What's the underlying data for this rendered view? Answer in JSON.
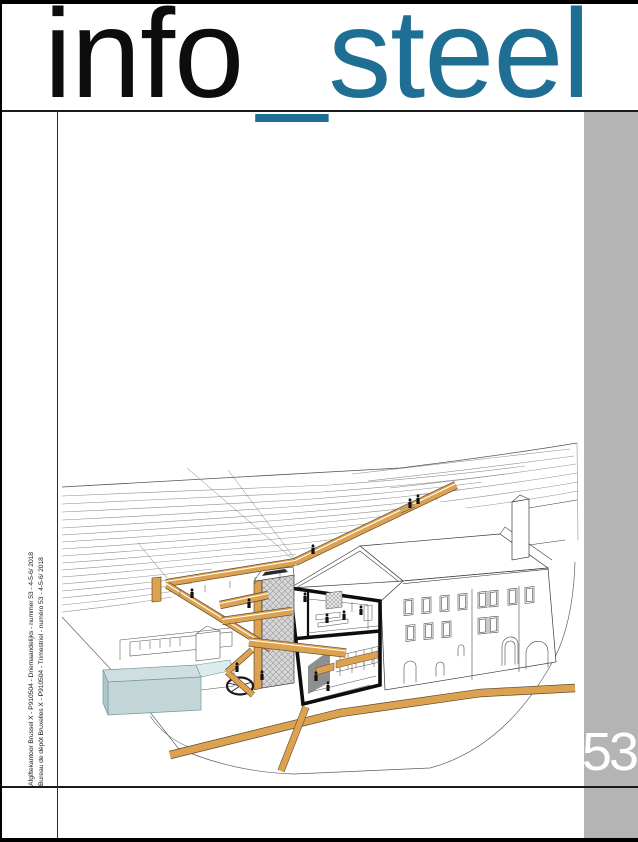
{
  "masthead": {
    "title_black": "info",
    "title_underscore": "_",
    "title_blue": "steel"
  },
  "sidebar": {
    "issue_number": "53"
  },
  "spine": {
    "line_nl": "Afgiftekantoor Brussel X - P910504 - Driemaandelijks - nummer 53 - 4-5-6/ 2018",
    "line_fr": "Bureau de dépôt Bruxelles X - P910504 - Trimestriel - numéro 53 - 4-5-6/ 2018"
  },
  "colors": {
    "accent_blue": "#1e6f93",
    "walkway_orange": "#dca24f",
    "sidebar_gray": "#b4b4b4",
    "basin_blue": "#c2d6d8"
  }
}
